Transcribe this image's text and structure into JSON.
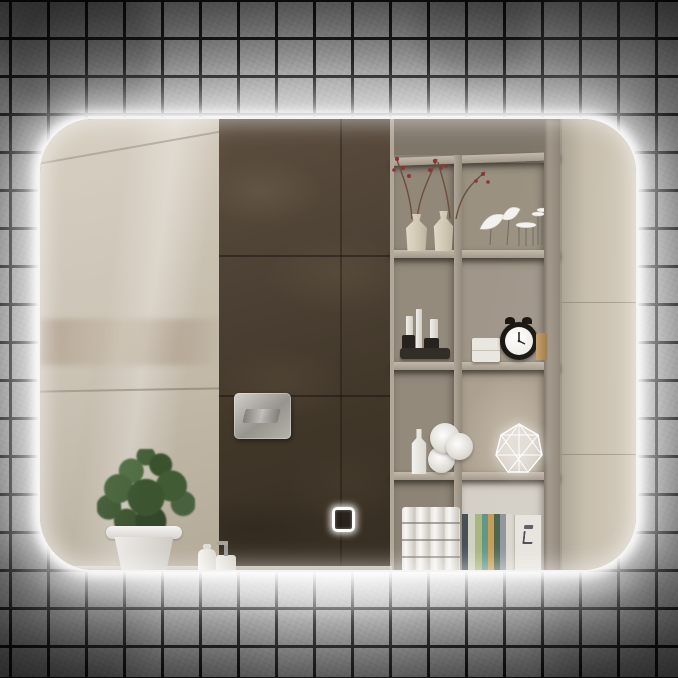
{
  "meta": {
    "image_kind": "product-photograph",
    "subject": "Rectangular LED back-lit bathroom mirror with rounded corners and touch sensor",
    "setting": "Mirror mounted on a dark grey square mosaic-tile wall; white LED halo glows around all four edges"
  },
  "palette": {
    "wall_tile_grey": "#a2a2a2",
    "wall_grout": "#151515",
    "corner_vignette": "#2c2c2c",
    "led_glow_white": "#ffffff",
    "beige_marble": "#c7beae",
    "dark_brown_marble": "#4c4134",
    "shelf_greige": "#968c7e",
    "shelf_board": "#b3a99b",
    "plant_green": "#45603a",
    "pot_white": "#eceae6",
    "clock_black": "#17130f",
    "chrome_flush_plate": "#b0ada7",
    "book_spines": [
      "#454b55",
      "#cfd2c0",
      "#a8b37c",
      "#5b9584",
      "#c59a52",
      "#46604a",
      "#8d939b"
    ]
  },
  "mirror": {
    "shape": "rounded-rectangle",
    "corner_radius_px": 56,
    "led_halo": "bright white glow on all edges, strongest below bottom edge",
    "touch_sensor": "small illuminated rounded-square outline near bottom centre of glass"
  },
  "reflection": {
    "left_wall": "large glossy beige marble tiles with faint diagonal joints and veining",
    "centre_column": "dark brown marble tile strip with chrome dual-flush toilet plate",
    "right_wall": "light beige stone tiles beside shelving unit",
    "shelving_unit": {
      "columns": 2,
      "rows": [
        {
          "left": "two cream ceramic vases with red-berry branches",
          "right": "white leaf/bird sculptures and tiny wire stands"
        },
        {
          "left": "cosmetic tubes and dark jars on a black tray",
          "right": "two stacked white boxes, black twin-bell alarm clock, small wooden block"
        },
        {
          "left": "white bottle and three rolled white towels",
          "right": "glowing white geometric faceted lamp"
        },
        {
          "left": "stacked white paper rolls",
          "right": "row of books with colourful spines and a white magazine showing a chair picture"
        }
      ]
    },
    "foreground": [
      "green leafy plant in a white flower pot on the counter",
      "small white cosmetic bottle",
      "white soap dispenser with grey pump"
    ]
  }
}
